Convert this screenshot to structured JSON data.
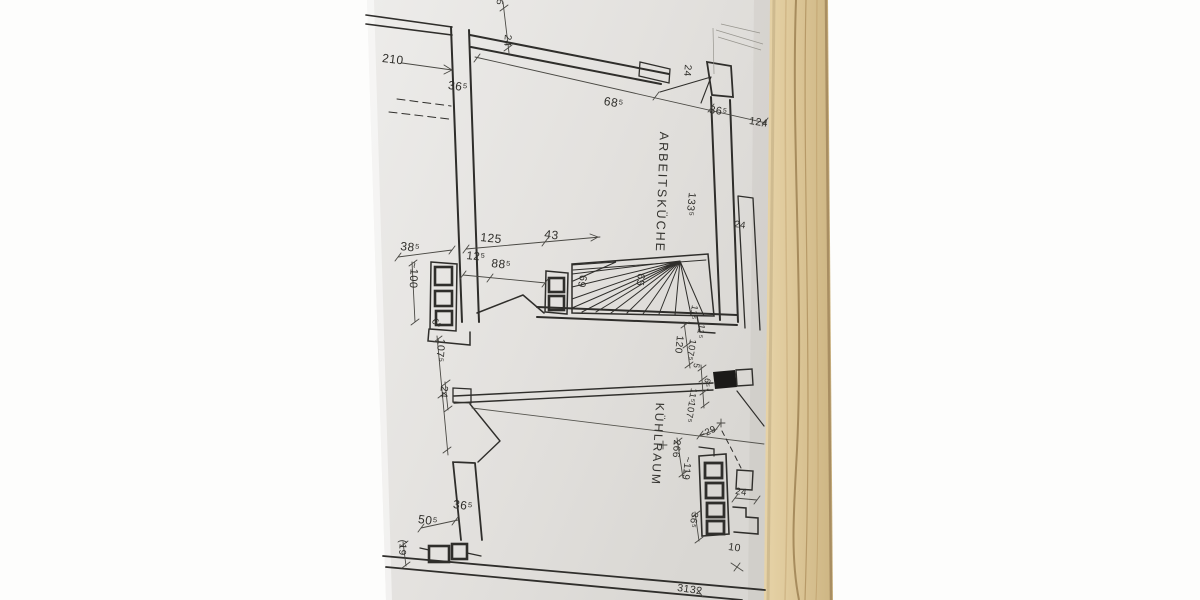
{
  "floor_plan": {
    "room_labels": [
      "ARBEITSKÜCHE",
      "KÜHLRAUM"
    ],
    "dims": [
      "210",
      "36⁵",
      "5",
      "24",
      "68⁵",
      "24",
      "36⁵",
      "124",
      "133⁵",
      "24",
      "125",
      "43",
      "38⁵",
      "12⁵",
      "88⁵",
      "~100",
      "69",
      "65",
      "6⁵",
      "11⁵",
      "11⁵",
      "120",
      "107⁵",
      "107⁵",
      "24",
      "5",
      "6⁵",
      "11⁵",
      "107⁵",
      "~29",
      "266",
      "~119",
      "24",
      "36⁵",
      "10",
      "36⁵",
      "50⁵",
      "(19",
      "3132"
    ],
    "colors": {
      "paper": "#e7e5e2",
      "ink": "#2f2e2b",
      "wood": "#dcc697",
      "background": "#fdfdfc"
    }
  }
}
